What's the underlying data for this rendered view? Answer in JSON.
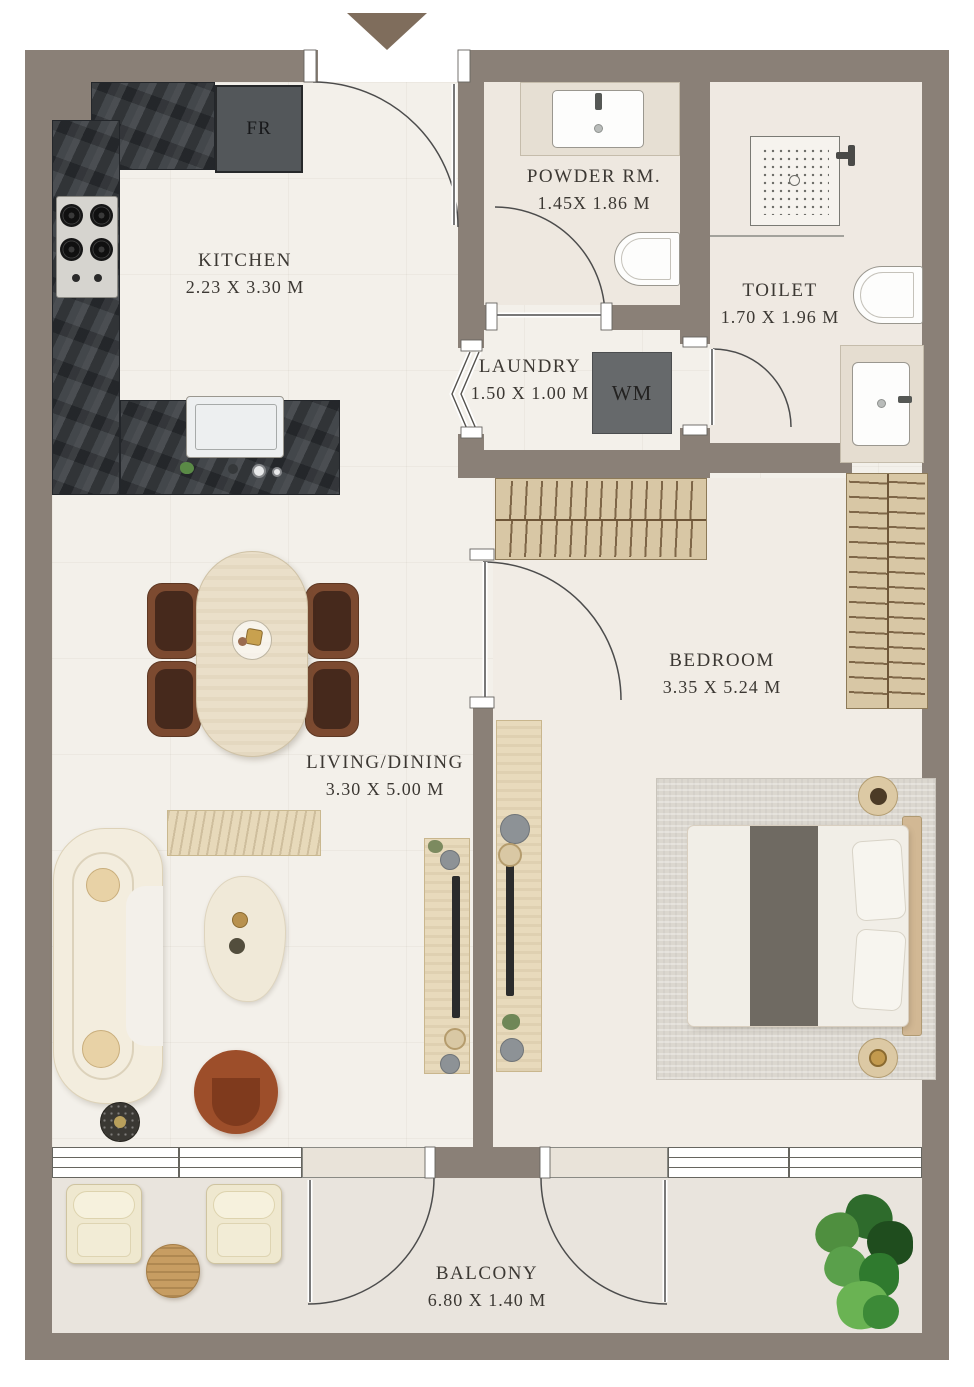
{
  "plan_title": "One-bedroom apartment floor plan",
  "rooms": {
    "kitchen": {
      "name": "KITCHEN",
      "dims": "2.23 X 3.30 M"
    },
    "powder": {
      "name": "POWDER RM.",
      "dims": "1.45X 1.86 M"
    },
    "toilet": {
      "name": "TOILET",
      "dims": "1.70 X 1.96 M"
    },
    "laundry": {
      "name": "LAUNDRY",
      "dims": "1.50 X 1.00 M"
    },
    "bedroom": {
      "name": "BEDROOM",
      "dims": "3.35 X 5.24 M"
    },
    "living": {
      "name": "LIVING/DINING",
      "dims": "3.30 X 5.00 M"
    },
    "balcony": {
      "name": "BALCONY",
      "dims": "6.80 X 1.40 M"
    }
  },
  "appliances": {
    "fridge": "FR",
    "washing_machine": "WM"
  },
  "icons": {
    "entry_arrow": "entry-direction-arrow"
  },
  "colors": {
    "wall": "#8A8077",
    "floor": "#F3F0EA",
    "counter_stone": "#3D4145",
    "wood_light": "#D8C7A5",
    "accent_rust": "#9D4E2A",
    "entry_arrow": "#7F6D5C",
    "label_text": "#3C3833"
  }
}
